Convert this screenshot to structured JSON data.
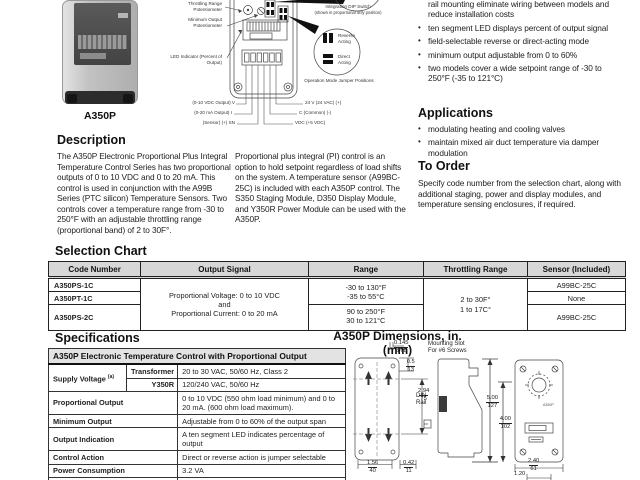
{
  "product": {
    "caption": "A350P"
  },
  "diagram": {
    "throttling_label": "Throttling Range Potentiometer",
    "min_output_label": "Minimum Output Potentiometer",
    "led_label": "LED Indicator (Percent of Output)",
    "dip_label": "Integration DIP Switch",
    "dip_note": "(shown in proportional only position)",
    "reverse_label": "Reverse Acting",
    "direct_label": "Direct Acting",
    "jumper_caption": "Operation Mode Jumper Positions",
    "wiring": {
      "v_out": "(0-10 VDC Output) V",
      "i_out": "(0-20 mA Output) I",
      "sensor": "(Sensor) (+) SN",
      "v24": "24 V  (24 VAC) (+)",
      "common": "C (Common) (-)",
      "vdc": "VDC (+5 VDC)"
    }
  },
  "features": {
    "bullets": [
      "rail mounting eliminate wiring between models and reduce installation costs",
      "ten segment LED displays percent of output signal",
      "field-selectable reverse or direct-acting mode",
      "minimum output adjustable from 0 to 60%",
      "two models cover a wide setpoint range of -30 to 250°F (-35 to 121°C)"
    ]
  },
  "applications": {
    "title": "Applications",
    "bullets": [
      "modulating heating and cooling valves",
      "maintain mixed air duct temperature via damper modulation"
    ]
  },
  "to_order": {
    "title": "To Order",
    "body": "Specify code number from the selection chart, along with additional staging, power and display modules, and temperature sensing enclosures, if required."
  },
  "description": {
    "title": "Description",
    "body": "The A350P Electronic Proportional Plus Integral Temperature Control Series has two proportional outputs of 0 to 10 VDC and 0 to 20 mA. This control is used in conjunction with the A99B Series (PTC silicon) Temperature Sensors. Two controls cover a temperature range from -30 to 250°F with an adjustable throttling range (proportional band) of 2 to 30F°."
  },
  "pi_note": "Proportional plus integral (PI) control is an option to hold setpoint regardless of load shifts on the system. A temperature sensor (A99BC-25C) is included with each A350P control. The S350 Staging Module, D350 Display Module, and Y350R Power Module can be used with the A350P.",
  "selection_chart": {
    "title": "Selection Chart",
    "headers": [
      "Code Number",
      "Output Signal",
      "Range",
      "Throttling Range",
      "Sensor (Included)"
    ],
    "codes": [
      "A350PS-1C",
      "A350PT-1C",
      "A350PS-2C"
    ],
    "output_signal": {
      "line1": "Proportional Voltage: 0 to 10 VDC",
      "line2": "and",
      "line3": "Proportional Current: 0 to 20 mA"
    },
    "range_a": {
      "line1": "-30 to 130°F",
      "line2": "-35 to 55°C"
    },
    "range_b": {
      "line1": "90 to 250°F",
      "line2": "30 to 121°C"
    },
    "throttling": {
      "line1": "2 to 30F°",
      "line2": "1 to 17C°"
    },
    "sensors": [
      "A99BC-25C",
      "None",
      "A99BC-25C"
    ]
  },
  "specifications": {
    "title": "Specifications",
    "table_title": "A350P Electronic Temperature Control with Proportional Output",
    "supply": {
      "label": "Supply Voltage",
      "sup": "(a)",
      "sub1_label": "Transformer",
      "sub1_value": "20 to 30 VAC, 50/60 Hz, Class 2",
      "sub2_label": "Y350R",
      "sub2_value": "120/240 VAC, 50/60 Hz"
    },
    "rows": [
      {
        "label": "Proportional Output",
        "value": "0 to 10 VDC (550 ohm load minimum) and 0 to 20 mA. (600 ohm load maximum)."
      },
      {
        "label": "Minimum Output",
        "value": "Adjustable from 0 to 60% of the output span"
      },
      {
        "label": "Output Indication",
        "value": "A ten segment LED indicates percentage of output"
      },
      {
        "label": "Control Action",
        "value": "Direct or reverse action is jumper selectable"
      },
      {
        "label": "Power Consumption",
        "value": "3.2 VA"
      },
      {
        "label": "",
        "value": "Three selectable rates fast, medium, slow"
      }
    ]
  },
  "dimensions": {
    "title": "A350P Dimensions, in. (mm)",
    "mounting_slot_1": "Mounting Slot",
    "mounting_slot_2": "For #6 Screws",
    "din_1": "DIN",
    "din_2": "Rail",
    "mini_label": "A350P",
    "fr_slot": {
      "in": "0.145",
      "mm": "3.68"
    },
    "fr_top": {
      "in": "0.5",
      "mm": "13"
    },
    "fr_side": {
      "in": "2.94",
      "mm": "75"
    },
    "fr_h1": {
      "in": "5.00",
      "mm": "127"
    },
    "fr_h2": {
      "in": "4.00",
      "mm": "102"
    },
    "fr_w1": {
      "in": "1.56",
      "mm": "40"
    },
    "fr_w2": {
      "in": "0.42",
      "mm": "11"
    },
    "fr_w3": {
      "in": "2.40",
      "mm": "61"
    },
    "fr_w4": {
      "in": "1.20",
      "mm": ""
    }
  }
}
